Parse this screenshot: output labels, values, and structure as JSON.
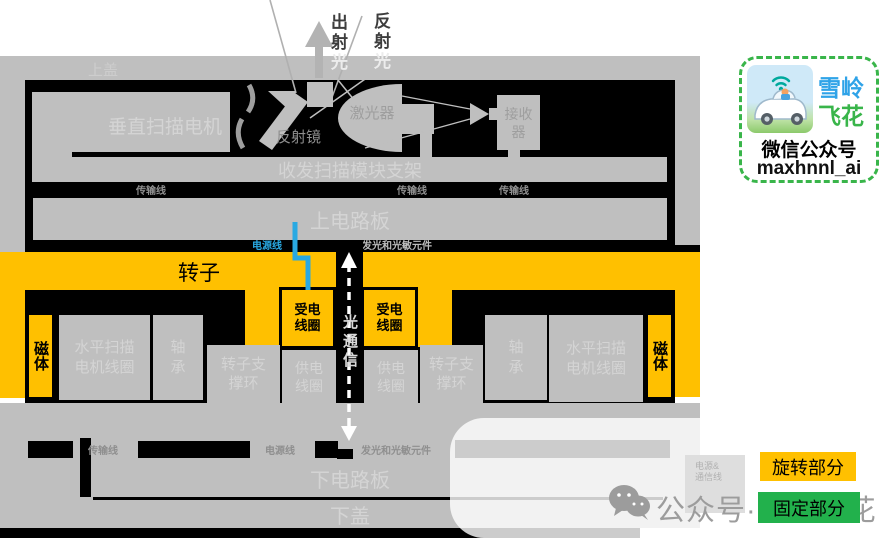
{
  "annotations": {
    "exit_dark": "出射",
    "exit_light": "光",
    "reflect_dark": "反射",
    "reflect_light": "光"
  },
  "housing": {
    "top_cover": "上盖",
    "bottom_cover": "下盖"
  },
  "optics": {
    "motor": "垂直扫描电机",
    "bracket": "收发扫描模块支架",
    "mirror": "反射镜",
    "laser": "激光器",
    "receiver_l1": "接收",
    "receiver_l2": "器"
  },
  "boards": {
    "upper": "上电路板",
    "lower": "下电路板"
  },
  "wires": {
    "transmission": "传输线",
    "power": "电源线",
    "emit_sense": "发光和光敏元件",
    "power_comm_l1": "电源&",
    "power_comm_l2": "通信线"
  },
  "rotor": {
    "label": "转子",
    "magnet": "磁体",
    "recv_l1": "受电",
    "recv_l2": "线圈"
  },
  "stator": {
    "h1": "水平扫描",
    "h2": "电机线圈",
    "b1": "轴",
    "b2": "承",
    "s1": "转子支",
    "s2": "撑环",
    "g1": "供电",
    "g2": "线圈"
  },
  "comm": {
    "optical": "光通信"
  },
  "legend": {
    "rotating": "旋转部分",
    "fixed": "固定部分"
  },
  "logo": {
    "brand1": "雪岭",
    "brand2": "飞花",
    "account_type": "微信公众号",
    "account_id": "maxhnnl_ai"
  },
  "watermark": {
    "text": "公众号·雪岭飞花"
  },
  "colors": {
    "rotating_yellow": "#FFC000",
    "fixed_green": "#22B14C",
    "power_blue": "#29A9E2",
    "emit_orange": "#ED7D31",
    "structure_gray": "#BFBFBF",
    "outline_black": "#000000"
  }
}
